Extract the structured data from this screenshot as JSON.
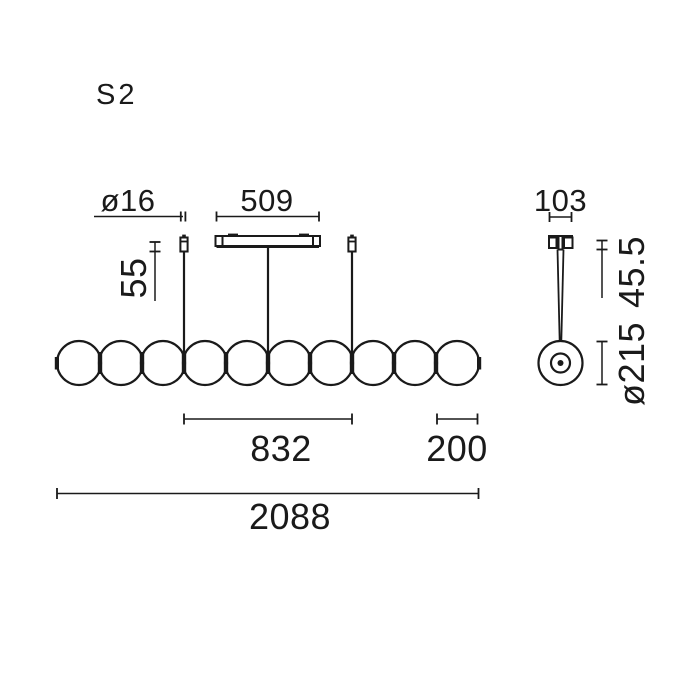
{
  "drawing": {
    "model_label": "S2",
    "colors": {
      "ink": "#1a1a1a",
      "background": "#ffffff"
    },
    "front_view": {
      "sphere_count": 10,
      "dims": {
        "wire_diameter": "ø16",
        "canopy_width": "509",
        "suspension_top_height": "55",
        "wire_spacing": "832",
        "end_segment": "200",
        "total_length": "2088"
      }
    },
    "side_view": {
      "dims": {
        "canopy_depth": "103",
        "canopy_height": "45.5",
        "sphere_diameter": "ø215"
      }
    }
  }
}
